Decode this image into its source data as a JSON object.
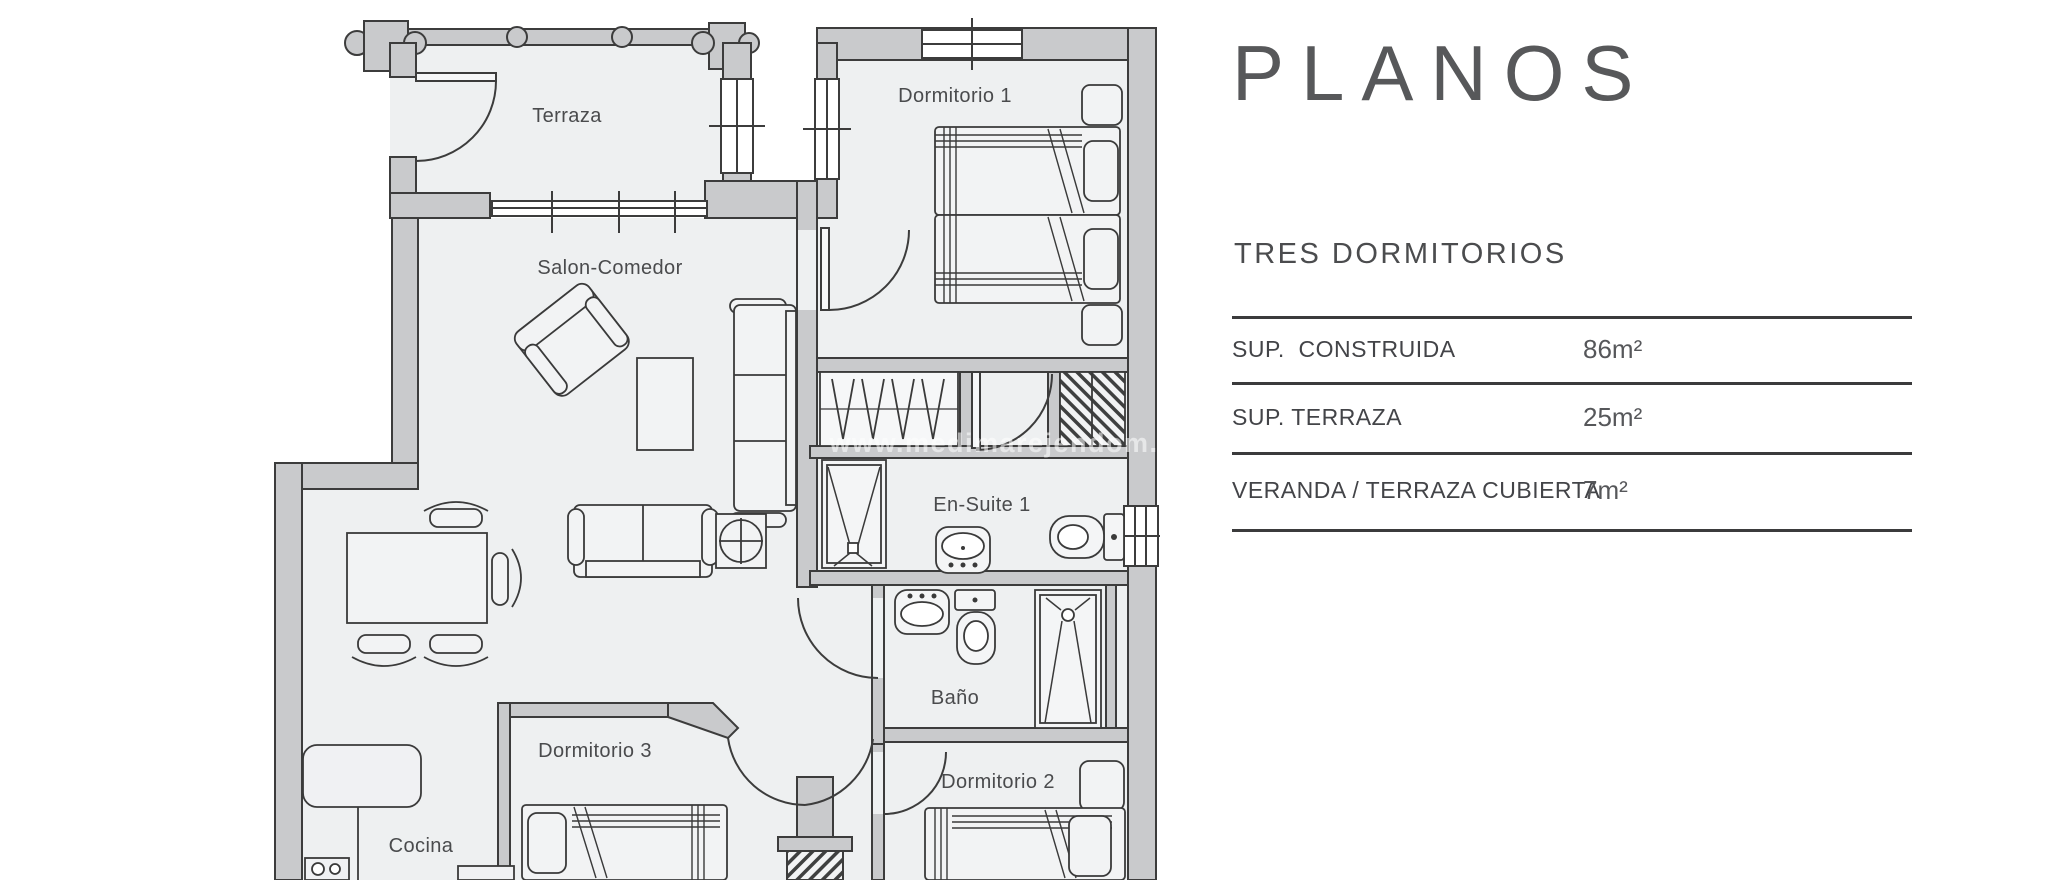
{
  "plan": {
    "rooms": {
      "terraza": "Terraza",
      "dormitorio1": "Dormitorio 1",
      "salon": "Salon-Comedor",
      "ensuite": "En-Suite 1",
      "bano": "Baño",
      "dormitorio3": "Dormitorio 3",
      "dormitorio2": "Dormitorio 2",
      "cocina": "Cocina"
    },
    "watermark": "www.medimarejendom.com"
  },
  "panel": {
    "title": "PLANOS",
    "subtitle": "TRES DORMITORIOS",
    "table": {
      "rows": [
        {
          "label": "SUP.  CONSTRUIDA",
          "value": "86m²"
        },
        {
          "label": "SUP. TERRAZA",
          "value": "25m²"
        },
        {
          "label": "VERANDA / TERRAZA CUBIERTA",
          "value": "7m²"
        }
      ]
    }
  },
  "colors": {
    "wall": "#c9cacc",
    "floor": "#eef0f1",
    "line": "#3c3c3c",
    "furniture_fill": "#f2f3f4",
    "label": "#4a4b4d",
    "title": "#57585a",
    "rule": "#3b3b3c",
    "background": "#ffffff"
  }
}
